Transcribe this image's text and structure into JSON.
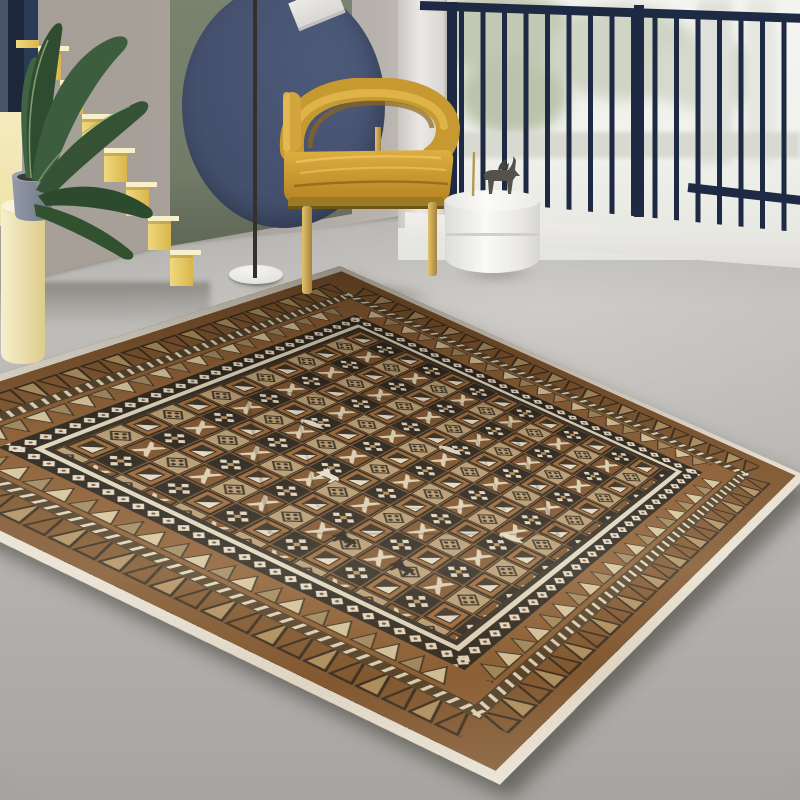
{
  "scene": {
    "type": "product-photo",
    "subject": "bohemian tribal area rug styled in a modern living room",
    "width_px": 800,
    "height_px": 800
  },
  "room": {
    "curtain": {
      "label": "navy curtain edge"
    },
    "sun_strip": {
      "label": "sunlit pale yellow wall strip"
    },
    "staircase": {
      "label": "yellow block staircase",
      "steps": 8
    },
    "plant": {
      "label": "banana-leaf plant in gray pot on cream pedestal",
      "leaves": 6
    },
    "green_panel": {
      "label": "sage green wall panel"
    },
    "wall_circle": {
      "label": "navy blue circular wall panel"
    },
    "floor_lamp": {
      "label": "black floor lamp with white disc base and tilted shade"
    },
    "armchair": {
      "label": "mustard velvet barrel armchair with brass legs"
    },
    "side_table": {
      "label": "white cylinder side table"
    },
    "figurine": {
      "label": "bronze animal figurine"
    },
    "window": {
      "label": "bright window with snowy foliage view"
    },
    "railing": {
      "label": "navy balcony railing",
      "bars": 16
    },
    "ledge": {
      "label": "white window ledge"
    },
    "floor": {
      "label": "gray concrete floor"
    }
  },
  "rug": {
    "label": "moroccan geometric area rug",
    "palette": [
      "brown",
      "black",
      "cream",
      "tan",
      "rust"
    ],
    "border_bands": [
      "white edge",
      "outlined triangle band",
      "cream dash band",
      "filled triangle band",
      "white diamond chain on black",
      "cream pinstripe",
      "dark pinstripe"
    ],
    "field_motifs": [
      "framed diagonal squares",
      "diamond cross on black",
      "dotted diamond on tan",
      "eight-point star on rust",
      "deer silhouettes",
      "bird silhouettes"
    ],
    "deer": {
      "black": 2,
      "white": 1
    },
    "birds": 3,
    "corners_px": {
      "top": [
        340,
        266
      ],
      "right": [
        807,
        476
      ],
      "bottom": [
        500,
        785
      ],
      "left": [
        -210,
        440
      ]
    }
  },
  "colors": {
    "floor-base": "#b7b5b2",
    "floor-dark": "#9c9a96",
    "wall-gray": "#a8a29b",
    "wall-light": "#d6d4d1",
    "green-panel": "#747e6a",
    "circle-blue": "#45516e",
    "curtain-navy": "#22304a",
    "stairs-front": "#e8cd66",
    "stairs-tread": "#f7f0c9",
    "sun-strip": "#f4ecc2",
    "leaf-green": "#35533a",
    "railing-navy": "#1e2a44",
    "window-white": "#f3f3f0",
    "ledge-white": "#edebe8",
    "chair-mustard": "#cf9e33",
    "chair-shadow": "#9a7119",
    "gold": "#c9a757",
    "lamp-pole": "#34312d",
    "lamp-base": "#ebebe8",
    "table-white": "#f4f4f2",
    "figurine-gray": "#55514b",
    "rug-white": "#f1ecdf",
    "rug-brown-deep": "#7d5128",
    "rug-field": "#8a5a2e",
    "rug-dark": "#241d14",
    "rug-black": "#211c15",
    "rug-cream": "#e9dfc5",
    "rug-tan": "#bb9e71",
    "rug-rust": "#7c4e26"
  }
}
